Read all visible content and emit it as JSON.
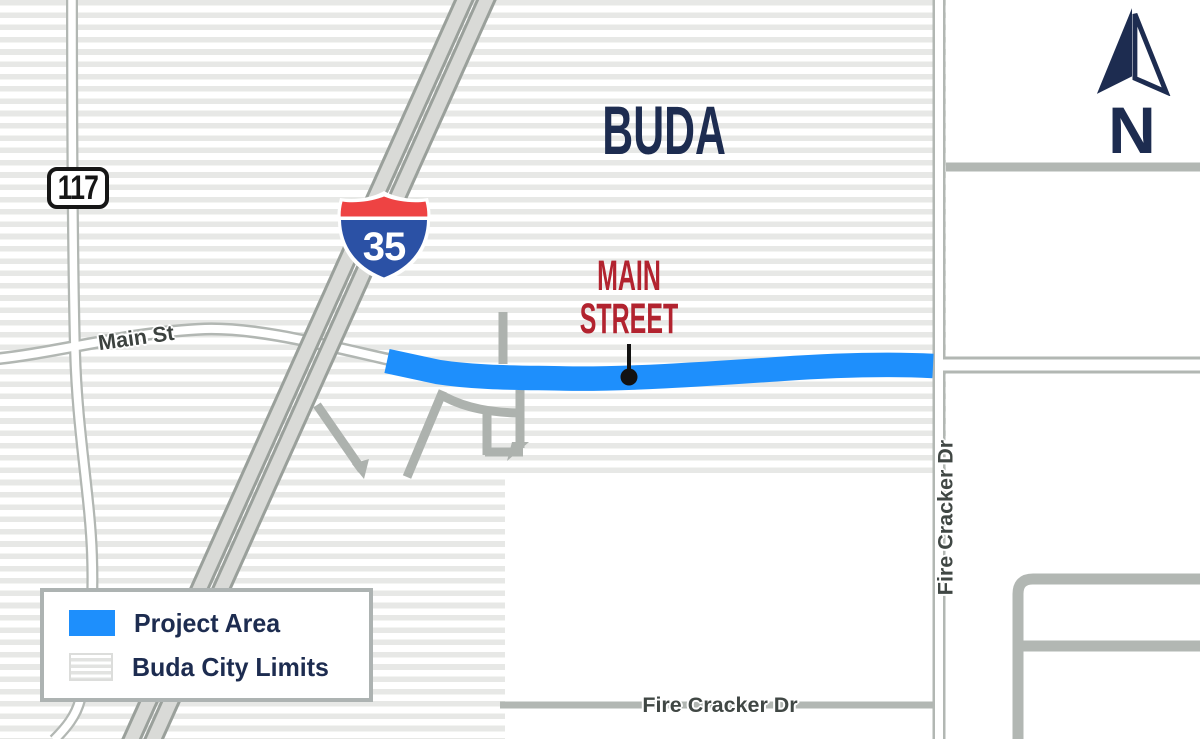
{
  "title": "Buda Main Street project area map",
  "map": {
    "city_label": "BUDA",
    "highway_badges": {
      "state": "117",
      "interstate": "35"
    },
    "road_labels": {
      "main_st": "Main St",
      "fire_cracker_dr_side": "Fire Cracker Dr",
      "fire_cracker_dr_bottom": "Fire Cracker Dr"
    },
    "callout": {
      "line1": "MAIN",
      "line2": "STREET"
    },
    "north_label": "N"
  },
  "legend": {
    "items": [
      {
        "label": "Project Area",
        "swatch": "project-area-swatch"
      },
      {
        "label": "Buda City Limits",
        "swatch": "city-limits-swatch"
      }
    ]
  },
  "colors": {
    "project_area_blue": "#1e8ffc",
    "navy": "#1d2c50",
    "street_label_red": "#b2232f",
    "interstate_blue": "#2b51a5",
    "interstate_red": "#ee4343",
    "city_limits_stripe": "#e7e8e6",
    "road_gray": "#b2b7b3"
  }
}
